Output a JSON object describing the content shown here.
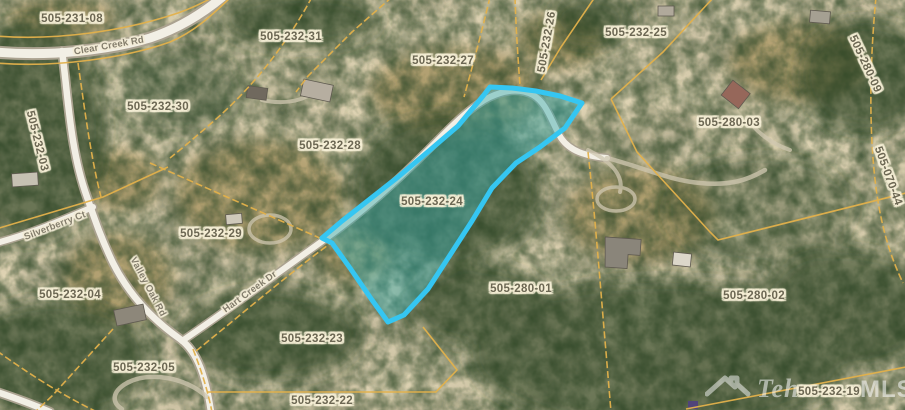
{
  "map": {
    "type": "aerial-parcel-map",
    "highlight": {
      "apn": "505-232-24",
      "stroke_color": "#35c6f2",
      "fill_color": "rgba(52,168,170,0.45)",
      "points": "483,96 490,87 512,88 536,91 560,96 582,103 565,128 540,147 516,163 492,188 472,221 452,252 428,289 404,315 388,322 372,300 350,268 332,243 322,238 342,221 370,199 398,177 430,150 458,126"
    },
    "boundary_color": "#e3b14b",
    "parcel_labels": [
      {
        "text": "505-231-08",
        "x": 72,
        "y": 19,
        "rot": 0
      },
      {
        "text": "505-232-31",
        "x": 291,
        "y": 37,
        "rot": 0
      },
      {
        "text": "505-232-27",
        "x": 443,
        "y": 61,
        "rot": 0
      },
      {
        "text": "505-232-26",
        "x": 547,
        "y": 42,
        "rot": -80
      },
      {
        "text": "505-232-25",
        "x": 636,
        "y": 33,
        "rot": 0
      },
      {
        "text": "505-280-09",
        "x": 865,
        "y": 64,
        "rot": 65
      },
      {
        "text": "505-280-03",
        "x": 729,
        "y": 123,
        "rot": 0
      },
      {
        "text": "505-070-44",
        "x": 888,
        "y": 176,
        "rot": 70
      },
      {
        "text": "505-232-03",
        "x": 37,
        "y": 141,
        "rot": 76
      },
      {
        "text": "505-232-30",
        "x": 158,
        "y": 107,
        "rot": 0
      },
      {
        "text": "505-232-28",
        "x": 330,
        "y": 146,
        "rot": 0
      },
      {
        "text": "505-232-29",
        "x": 211,
        "y": 234,
        "rot": 0
      },
      {
        "text": "505-232-24",
        "x": 432,
        "y": 202,
        "rot": 0
      },
      {
        "text": "505-232-04",
        "x": 70,
        "y": 295,
        "rot": 0
      },
      {
        "text": "505-232-05",
        "x": 144,
        "y": 368,
        "rot": 0
      },
      {
        "text": "505-232-23",
        "x": 312,
        "y": 339,
        "rot": 0
      },
      {
        "text": "505-232-22",
        "x": 322,
        "y": 401,
        "rot": 0
      },
      {
        "text": "505-280-01",
        "x": 521,
        "y": 289,
        "rot": 0
      },
      {
        "text": "505-280-02",
        "x": 754,
        "y": 296,
        "rot": 0
      },
      {
        "text": "505-232-19",
        "x": 829,
        "y": 392,
        "rot": 0
      }
    ],
    "road_labels": [
      {
        "text": "Clear Creek Rd",
        "x": 109,
        "y": 46,
        "rot": -10
      },
      {
        "text": "Silverberry Ct",
        "x": 55,
        "y": 226,
        "rot": -21
      },
      {
        "text": "Valley Oak Rd",
        "x": 148,
        "y": 287,
        "rot": 62
      },
      {
        "text": "Hart Creek Dr",
        "x": 250,
        "y": 292,
        "rot": -36
      }
    ],
    "watermark": {
      "brand_left": "Teha",
      "brand_right": "MLS"
    }
  }
}
